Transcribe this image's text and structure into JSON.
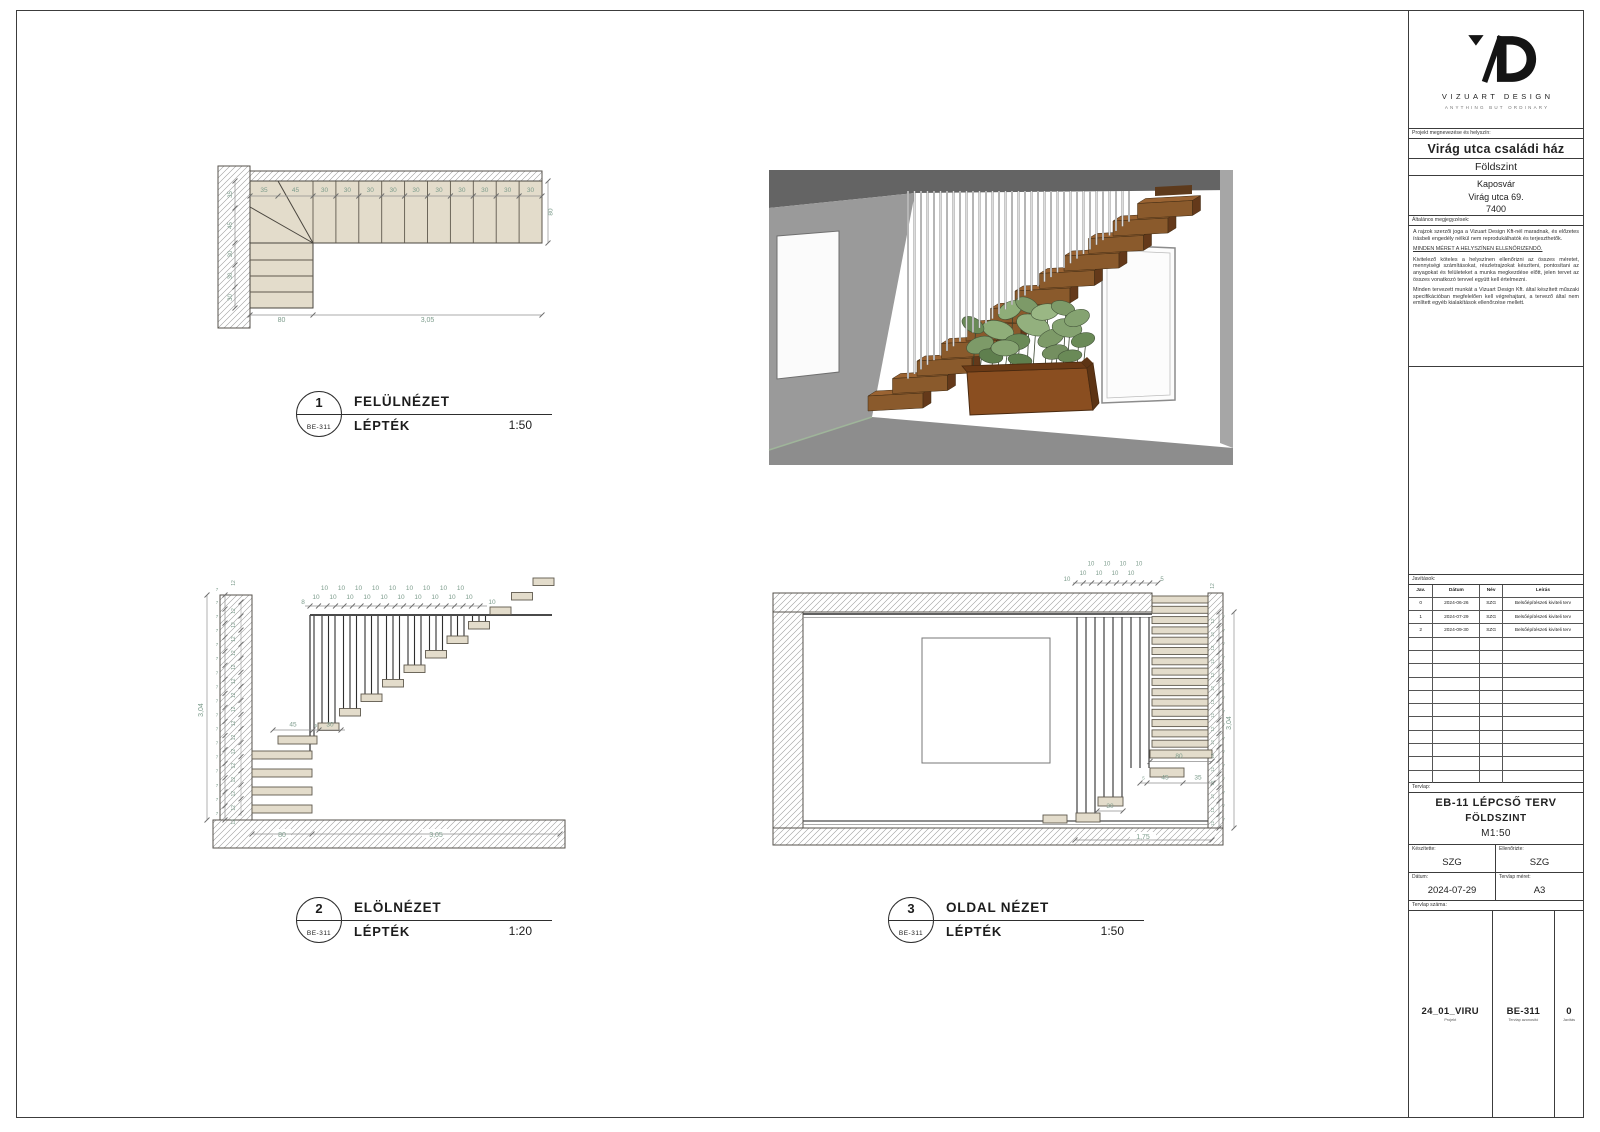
{
  "views": [
    {
      "number": "1",
      "ref": "BE-311",
      "title": "FELÜLNÉZET",
      "scale_label": "LÉPTÉK",
      "scale": "1:50"
    },
    {
      "number": "2",
      "ref": "BE-311",
      "title": "ELÖLNÉZET",
      "scale_label": "LÉPTÉK",
      "scale": "1:20"
    },
    {
      "number": "3",
      "ref": "BE-311",
      "title": "OLDAL NÉZET",
      "scale_label": "LÉPTÉK",
      "scale": "1:50"
    }
  ],
  "plan_view": {
    "dims_top": [
      "35",
      "45",
      "30",
      "30",
      "30",
      "30",
      "30",
      "30",
      "30",
      "30",
      "30",
      "30"
    ],
    "dims_left": [
      "35",
      "45",
      "30",
      "30",
      "30"
    ],
    "dim_right": "80",
    "dim_bottom_left": "80",
    "dim_bottom_right": "3,05"
  },
  "front_view": {
    "dim_total_height": "3,04",
    "dim_top_first": "8",
    "dim_top_run": "10",
    "dim_top_last": "10",
    "tread_dim": "7",
    "riser_dim": "12",
    "dim_mid_a": "45",
    "dim_mid_b": "5",
    "dim_mid_c": "30",
    "dim_bottom_left": "80",
    "dim_bottom_right": "3,05"
  },
  "side_view": {
    "dim_total_height": "3,04",
    "dim_top_run": "10",
    "dim_top_first": "10",
    "dim_top_last": "5",
    "tread_dim": "7",
    "riser_dim": "12",
    "dim_width_top": "80",
    "dim_lower_a": "5",
    "dim_lower_b": "45",
    "dim_lower_c": "35",
    "dim_lower_d": "30",
    "dim_bottom": "1,75"
  },
  "titleblock": {
    "brand": "VIZUART DESIGN",
    "tagline": "ANYTHING BUT ORDINARY",
    "project_label": "Projekt megnevezése és helyszín:",
    "project_name": "Virág utca családi ház",
    "project_level": "Földszint",
    "address": [
      "Kaposvár",
      "Virág utca 69.",
      "7400"
    ],
    "notes_label": "Általános megjegyzések:",
    "notes": [
      "A rajzok szerzői joga a Vizuart Design Kft-nél maradnak, és előzetes írásbeli engedély nélkül nem reprodukálhatók és terjeszthetők.",
      "MINDEN MÉRET A HELYSZÍNEN ELLENŐRIZENDŐ.",
      "Kivitelező köteles a helyszínen ellenőrizni az összes méretet, mennyiségi számításokat, részletrajzokat készíteni, pontosítani az anyagokat és felületeket a munka megkezdése előtt, jelen tervet az összes vonatkozó tervvel együtt kell értelmezni.",
      "Minden tervezett munkát a Vizuart Design Kft. által készített műszaki specifikációban megfelelően kell végrehajtani, a tervező által nem említett egyéb kialakítások ellenőrzése mellett."
    ],
    "revisions_label": "Javítások:",
    "revisions_columns": [
      "Jav.",
      "Dátum",
      "Név",
      "Leírás"
    ],
    "revisions": [
      {
        "no": "0",
        "date": "2024-06-26",
        "name": "SZG",
        "desc": "Belsőépítészeti kiviteli terv"
      },
      {
        "no": "1",
        "date": "2024-07-29",
        "name": "SZG",
        "desc": "Belsőépítészeti kiviteli terv"
      },
      {
        "no": "2",
        "date": "2024-09-30",
        "name": "SZG",
        "desc": "Belsőépítészeti kiviteli terv"
      }
    ],
    "sheet_label": "Tervlap:",
    "sheet_title": "EB-11 LÉPCSŐ TERV",
    "sheet_subtitle": "FÖLDSZINT",
    "sheet_scale": "M1:50",
    "made_by_label": "Készítette:",
    "made_by": "SZG",
    "checked_by_label": "Ellenőrizte:",
    "checked_by": "SZG",
    "date_label": "Dátum:",
    "date": "2024-07-29",
    "size_label": "Tervlap méret:",
    "size": "A3",
    "number_label": "Tervlap száma:",
    "project_code": "24_01_VIRU",
    "project_code_sub": "Projekt",
    "sheet_id": "BE-311",
    "sheet_id_sub": "Tervlap azonosító",
    "rev_no": "0",
    "rev_no_sub": "Javítás"
  },
  "colors": {
    "dimension_text": "#7d9c8c",
    "tread_fill": "#e3dccb",
    "stair_wood": "#8a5a2c",
    "plant_green": "#7d9a68"
  }
}
